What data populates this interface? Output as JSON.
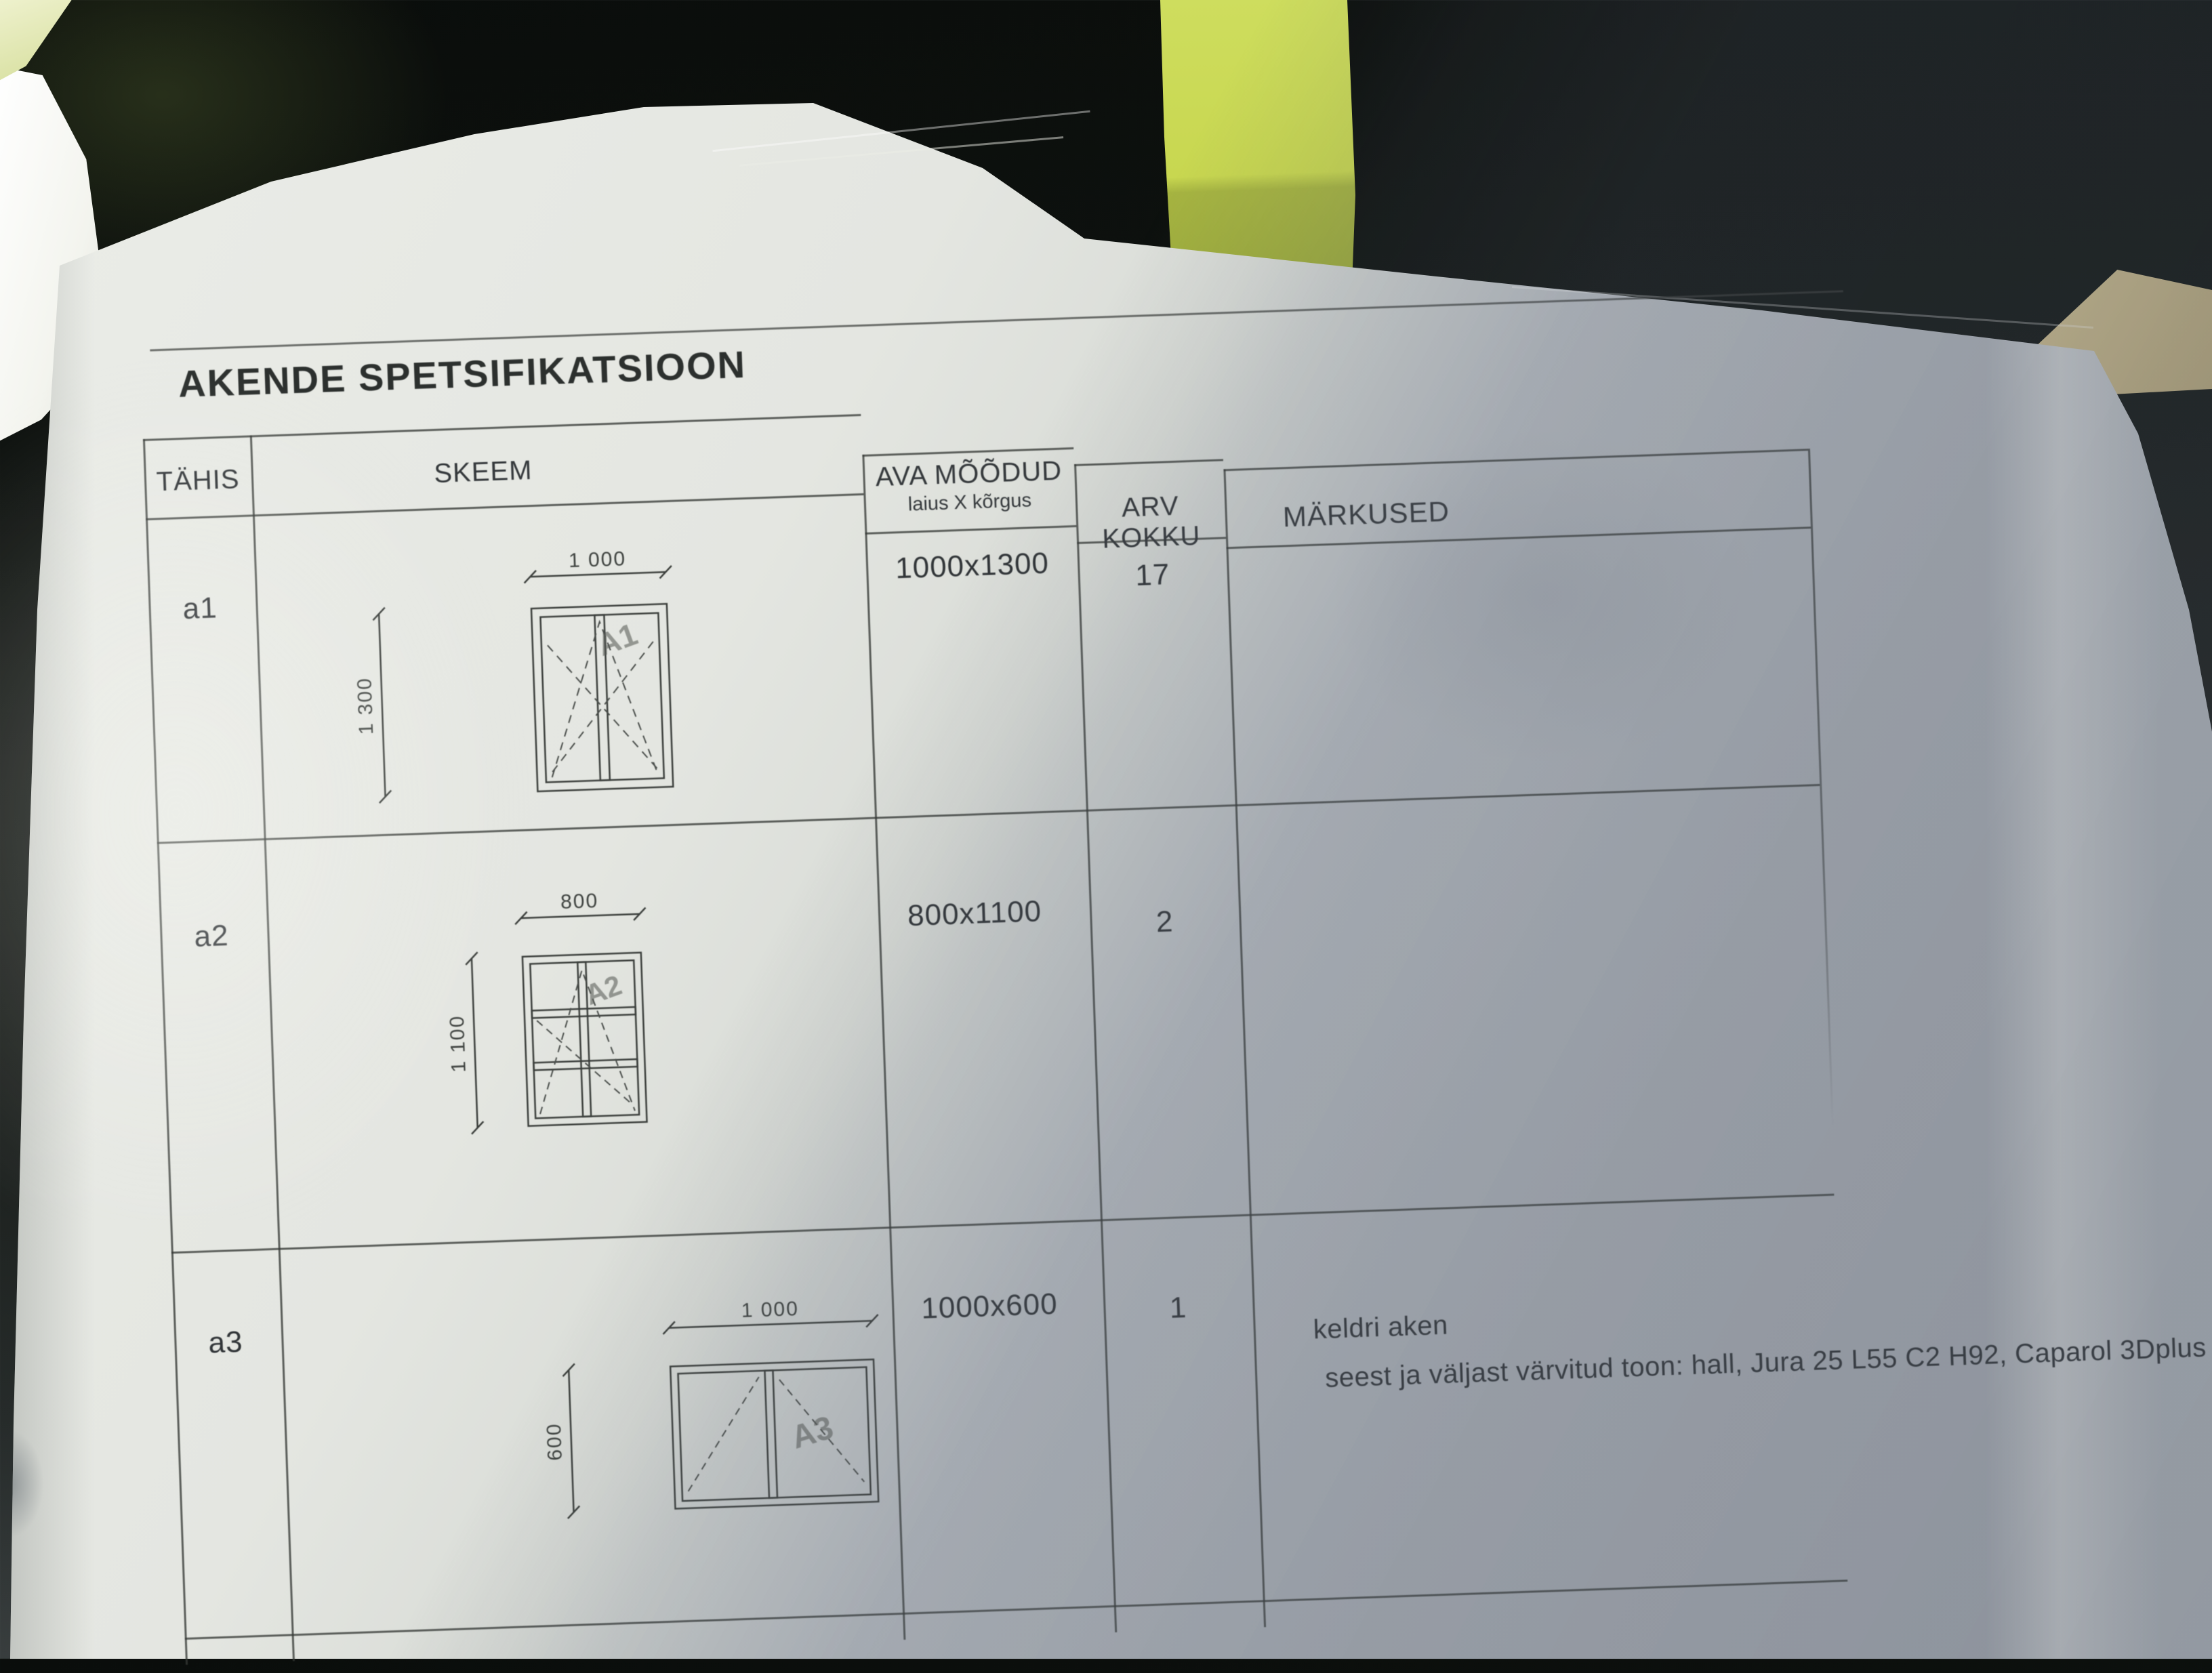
{
  "photo": {
    "background_color": "#121613",
    "paper_color": "#e4e6e1",
    "paper_shadow_color": "#aaafb6",
    "strap_color": "#c8d750",
    "strap_shadow_color": "#9cab3a",
    "ink_color": "#33373a"
  },
  "document": {
    "title": "AKENDE SPETSIFIKATSIOON",
    "header": {
      "tahis": "TÄHIS",
      "skeem": "SKEEM",
      "ava_moodud": "AVA MÕÕDUD",
      "ava_moodud_sub": "laius X kõrgus",
      "arv_kokku": "ARV KOKKU",
      "markused": "MÄRKUSED"
    },
    "rows": [
      {
        "tahis": "a1",
        "skeem": {
          "width_label": "1 000",
          "height_label": "1 300",
          "sketch_label": "A1"
        },
        "ava_moodud": "1000x1300",
        "arv_kokku": "17"
      },
      {
        "tahis": "a2",
        "skeem": {
          "width_label": "800",
          "height_label": "1 100",
          "sketch_label": "A2"
        },
        "ava_moodud": "800x1100",
        "arv_kokku": "2"
      },
      {
        "tahis": "a3",
        "skeem": {
          "width_label": "1 000",
          "height_label": "600",
          "sketch_label": "A3"
        },
        "ava_moodud": "1000x600",
        "arv_kokku": "1",
        "markused": [
          "keldri aken",
          "seest ja väljast värvitud toon: hall, Jura 25 L55 C2 H92, Caparol 3Dplus"
        ]
      }
    ]
  }
}
